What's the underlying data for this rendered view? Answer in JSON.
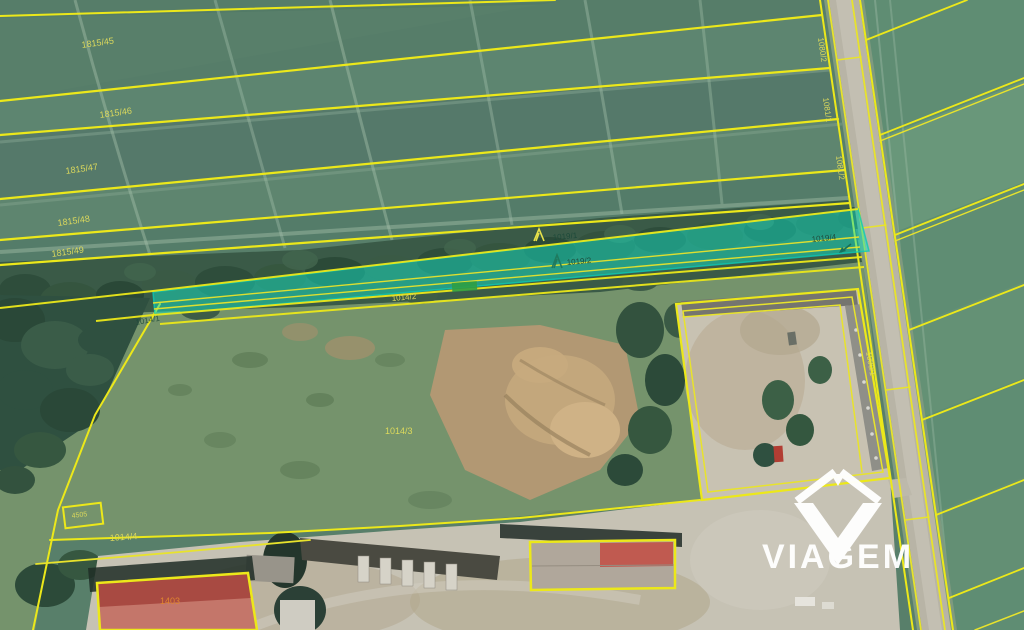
{
  "watermark": {
    "text": "VIAGEM"
  },
  "parcel_labels": {
    "l1815_45": "1815/45",
    "l1815_46": "1815/46",
    "l1815_47": "1815/47",
    "l1815_48": "1815/48",
    "l1815_49": "1815/49",
    "l1019_1": "1019/1",
    "l1019_2": "1019/2",
    "l1019_4": "1019/4",
    "l1014_1": "1014/1",
    "l1014_2": "1014/2",
    "l1014_3": "1014/3",
    "l1014_4": "1014/4",
    "l4505": "4505",
    "l1403": "1403",
    "l1080_2": "1080/2",
    "l1081_1": "1081/1",
    "l1081_2": "1081/2",
    "l1090_1": "1090/1"
  },
  "colors": {
    "cadastral_line": "#ece81a",
    "label_yellow": "#dcd95c",
    "label_dark": "#1d4a3a",
    "label_orange": "#e0862f",
    "highlight_fill": "#13dfc4",
    "highlight_edge": "#0cc9b4",
    "watermark": "#ffffff",
    "road": "#b7b3a5",
    "field_green": "#587f6a"
  }
}
